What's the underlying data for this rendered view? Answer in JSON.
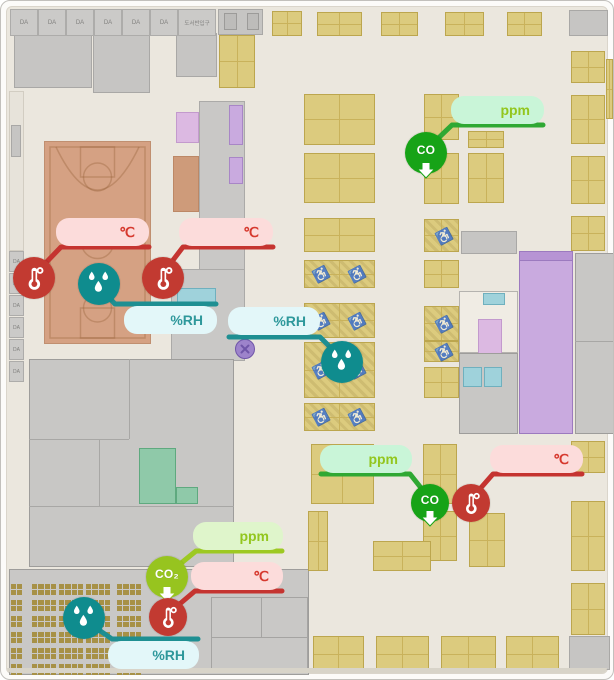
{
  "meta": {
    "title": "Library floor plan with environment sensors"
  },
  "strips": {
    "top_cells": {
      "labels": [
        "DA",
        "DA",
        "DA",
        "DA",
        "DA",
        "DA",
        "도서반입구"
      ],
      "x0": 9,
      "y": 8,
      "h": 27,
      "w": 28,
      "last_w": 38
    },
    "left_cells": {
      "labels": [
        "DA",
        "DP",
        "DA",
        "DA",
        "DA",
        "DA"
      ],
      "x": 8,
      "w": 15,
      "h": 21,
      "ys": [
        250,
        272,
        294,
        316,
        338,
        360
      ]
    }
  },
  "regions": [
    {
      "n": "left-corridor",
      "x": 8,
      "y": 90,
      "w": 15,
      "h": 160,
      "f": "#E7E3DA",
      "s": "#D2CDC2",
      "p": "p-vlinesg"
    },
    {
      "n": "left-gray-box",
      "x": 10,
      "y": 124,
      "w": 10,
      "h": 32,
      "f": "#C6C5C3",
      "s": "#A9A8A6"
    },
    {
      "n": "room-tl-1",
      "x": 13,
      "y": 32,
      "w": 78,
      "h": 55,
      "f": "#C6C5C3",
      "s": "#A9A8A6"
    },
    {
      "n": "room-tl-2",
      "x": 92,
      "y": 32,
      "w": 57,
      "h": 60,
      "f": "#C6C5C3",
      "s": "#A9A8A6"
    },
    {
      "n": "room-tl-3",
      "x": 175,
      "y": 32,
      "w": 41,
      "h": 44,
      "f": "#C6C5C3",
      "s": "#A9A8A6"
    },
    {
      "n": "equip-room-top",
      "x": 217,
      "y": 8,
      "w": 45,
      "h": 26,
      "f": "#C6C5C3",
      "s": "#A9A8A6"
    },
    {
      "n": "equip-box-a",
      "x": 223,
      "y": 12,
      "w": 13,
      "h": 17,
      "f": "#BDBCBA",
      "s": "#9C9B99"
    },
    {
      "n": "equip-box-b",
      "x": 246,
      "y": 12,
      "w": 12,
      "h": 17,
      "f": "#BDBCBA",
      "s": "#9C9B99"
    },
    {
      "n": "gray-top-right",
      "x": 568,
      "y": 9,
      "w": 39,
      "h": 26,
      "f": "#C6C5C3",
      "s": "#A9A8A6"
    },
    {
      "n": "corridor-mid",
      "x": 198,
      "y": 100,
      "w": 46,
      "h": 170,
      "f": "#C9C8C6",
      "s": "#ABAAA8"
    },
    {
      "n": "corridor-mid-low",
      "x": 170,
      "y": 268,
      "w": 74,
      "h": 92,
      "f": "#C9C8C6",
      "s": "#ABAAA8"
    },
    {
      "n": "stairs-pink",
      "x": 175,
      "y": 111,
      "w": 23,
      "h": 31,
      "f": "#DCB9E2",
      "s": "#C39ACD",
      "p": "p-stairs"
    },
    {
      "n": "bleacher-strip",
      "x": 172,
      "y": 155,
      "w": 26,
      "h": 56,
      "f": "#CE9B7A",
      "s": "#BC8866",
      "p": "p-hatchw"
    },
    {
      "n": "escalator-1",
      "x": 228,
      "y": 104,
      "w": 14,
      "h": 40,
      "f": "#C9AADF",
      "s": "#A886C6",
      "p": "p-stairs"
    },
    {
      "n": "escalator-2",
      "x": 228,
      "y": 156,
      "w": 14,
      "h": 27,
      "f": "#C9AADF",
      "s": "#A886C6",
      "p": "p-stairs"
    },
    {
      "n": "cyan-room-strip",
      "x": 176,
      "y": 287,
      "w": 39,
      "h": 15,
      "f": "#9FD2DB",
      "s": "#6FB0BE"
    },
    {
      "n": "court",
      "x": 43,
      "y": 140,
      "w": 107,
      "h": 203,
      "f": "#D5A183",
      "s": "#C08F70"
    },
    {
      "n": "block-left-big",
      "x": 28,
      "y": 358,
      "w": 205,
      "h": 208,
      "f": "#C8C7C5",
      "s": "#9E9D9B"
    },
    {
      "n": "block-line-1",
      "x": 28,
      "y": 438,
      "w": 100,
      "h": 1,
      "f": "#A8A7A5"
    },
    {
      "n": "block-line-2",
      "x": 128,
      "y": 358,
      "w": 1,
      "h": 80,
      "f": "#A8A7A5"
    },
    {
      "n": "block-line-3",
      "x": 28,
      "y": 505,
      "w": 205,
      "h": 1,
      "f": "#A8A7A5"
    },
    {
      "n": "block-line-4",
      "x": 98,
      "y": 438,
      "w": 1,
      "h": 67,
      "f": "#A8A7A5"
    },
    {
      "n": "meeting-room-teal",
      "x": 138,
      "y": 447,
      "w": 37,
      "h": 56,
      "f": "#8FC9A9",
      "s": "#5FA97F"
    },
    {
      "n": "meeting-room-teal-ext",
      "x": 175,
      "y": 486,
      "w": 22,
      "h": 17,
      "f": "#8FC9A9",
      "s": "#5FA97F"
    },
    {
      "n": "bottom-slab",
      "x": 8,
      "y": 568,
      "w": 300,
      "h": 106,
      "f": "#C9C8C6",
      "s": "#9E9D9B"
    },
    {
      "n": "slab-rooms-hatch",
      "x": 210,
      "y": 596,
      "w": 97,
      "h": 76,
      "f": "rgba(0,0,0,0)",
      "s": "#A5A4A2",
      "p": "p-hatchw"
    },
    {
      "n": "slab-room-line-v",
      "x": 260,
      "y": 596,
      "w": 1,
      "h": 40,
      "f": "#A5A4A2"
    },
    {
      "n": "slab-room-line-h",
      "x": 210,
      "y": 636,
      "w": 97,
      "h": 1,
      "f": "#A5A4A2"
    },
    {
      "n": "equip-room-center",
      "x": 460,
      "y": 230,
      "w": 56,
      "h": 23,
      "f": "#C6C5C3",
      "s": "#A9A8A6"
    },
    {
      "n": "lecture-hall-purple",
      "x": 518,
      "y": 250,
      "w": 54,
      "h": 183,
      "f": "#C9AADF",
      "s": "#9C7ABF",
      "p": "p-vlines"
    },
    {
      "n": "lecture-hall-header",
      "x": 518,
      "y": 250,
      "w": 54,
      "h": 10,
      "f": "#B794D4",
      "s": "#9C7ABF"
    },
    {
      "n": "gray-col-right",
      "x": 574,
      "y": 252,
      "w": 40,
      "h": 181,
      "f": "#C8C7C5",
      "s": "#9E9D9B"
    },
    {
      "n": "gray-col-line",
      "x": 574,
      "y": 340,
      "w": 40,
      "h": 1,
      "f": "#A8A7A5"
    },
    {
      "n": "rooms-center-white",
      "x": 458,
      "y": 290,
      "w": 59,
      "h": 62,
      "f": "#F0ECE4",
      "s": "#B5B3AF"
    },
    {
      "n": "cyan-small",
      "x": 482,
      "y": 292,
      "w": 22,
      "h": 12,
      "f": "#9FD2DB",
      "s": "#6FB0BE"
    },
    {
      "n": "stairs-pink-2",
      "x": 477,
      "y": 318,
      "w": 24,
      "h": 36,
      "f": "#DCB9E2",
      "s": "#C39ACD",
      "p": "p-stairs"
    },
    {
      "n": "gray-block-center",
      "x": 458,
      "y": 352,
      "w": 59,
      "h": 81,
      "f": "#C8C7C5",
      "s": "#9E9D9B"
    },
    {
      "n": "cyan-pair-a",
      "x": 462,
      "y": 366,
      "w": 19,
      "h": 20,
      "f": "#9FD2DB",
      "s": "#6FB0BE"
    },
    {
      "n": "cyan-pair-b",
      "x": 483,
      "y": 366,
      "w": 18,
      "h": 20,
      "f": "#9FD2DB",
      "s": "#6FB0BE"
    },
    {
      "n": "gray-corner-br",
      "x": 568,
      "y": 635,
      "w": 41,
      "h": 34,
      "f": "#C6C5C3",
      "s": "#A9A8A6"
    }
  ],
  "desks": [
    {
      "x": 271,
      "y": 10,
      "w": 30,
      "h": 25
    },
    {
      "x": 316,
      "y": 11,
      "w": 45,
      "h": 24
    },
    {
      "x": 380,
      "y": 11,
      "w": 37,
      "h": 24
    },
    {
      "x": 444,
      "y": 11,
      "w": 39,
      "h": 24
    },
    {
      "x": 506,
      "y": 11,
      "w": 35,
      "h": 24
    },
    {
      "x": 218,
      "y": 34,
      "w": 36,
      "h": 53
    },
    {
      "x": 570,
      "y": 50,
      "w": 34,
      "h": 32
    },
    {
      "x": 570,
      "y": 94,
      "w": 34,
      "h": 49
    },
    {
      "x": 570,
      "y": 155,
      "w": 34,
      "h": 48
    },
    {
      "x": 570,
      "y": 215,
      "w": 34,
      "h": 35
    },
    {
      "x": 605,
      "y": 58,
      "w": 7,
      "h": 60
    },
    {
      "x": 303,
      "y": 93,
      "w": 71,
      "h": 51
    },
    {
      "x": 423,
      "y": 93,
      "w": 35,
      "h": 46
    },
    {
      "x": 303,
      "y": 152,
      "w": 71,
      "h": 50
    },
    {
      "x": 423,
      "y": 152,
      "w": 35,
      "h": 51
    },
    {
      "x": 467,
      "y": 130,
      "w": 36,
      "h": 17
    },
    {
      "x": 467,
      "y": 152,
      "w": 36,
      "h": 50
    },
    {
      "x": 303,
      "y": 217,
      "w": 71,
      "h": 34
    },
    {
      "x": 423,
      "y": 218,
      "w": 35,
      "h": 33,
      "wc": true
    },
    {
      "x": 303,
      "y": 259,
      "w": 71,
      "h": 28,
      "wc": true
    },
    {
      "x": 423,
      "y": 259,
      "w": 35,
      "h": 28
    },
    {
      "x": 303,
      "y": 302,
      "w": 71,
      "h": 35,
      "wc": true
    },
    {
      "x": 423,
      "y": 305,
      "w": 35,
      "h": 35,
      "wc": true
    },
    {
      "x": 303,
      "y": 341,
      "w": 71,
      "h": 56,
      "wc": true
    },
    {
      "x": 423,
      "y": 340,
      "w": 35,
      "h": 21,
      "wc": true
    },
    {
      "x": 423,
      "y": 366,
      "w": 35,
      "h": 31
    },
    {
      "x": 303,
      "y": 402,
      "w": 71,
      "h": 28,
      "wc": true
    },
    {
      "x": 310,
      "y": 443,
      "w": 63,
      "h": 60
    },
    {
      "x": 307,
      "y": 510,
      "w": 20,
      "h": 60
    },
    {
      "x": 422,
      "y": 443,
      "w": 34,
      "h": 60
    },
    {
      "x": 422,
      "y": 510,
      "w": 34,
      "h": 50
    },
    {
      "x": 468,
      "y": 512,
      "w": 36,
      "h": 54
    },
    {
      "x": 372,
      "y": 540,
      "w": 58,
      "h": 30
    },
    {
      "x": 570,
      "y": 440,
      "w": 34,
      "h": 32
    },
    {
      "x": 570,
      "y": 500,
      "w": 34,
      "h": 70
    },
    {
      "x": 570,
      "y": 582,
      "w": 34,
      "h": 52
    },
    {
      "x": 312,
      "y": 635,
      "w": 51,
      "h": 36
    },
    {
      "x": 375,
      "y": 635,
      "w": 53,
      "h": 36
    },
    {
      "x": 440,
      "y": 635,
      "w": 55,
      "h": 36
    },
    {
      "x": 505,
      "y": 635,
      "w": 53,
      "h": 36
    }
  ],
  "classroom": {
    "cols": [
      {
        "x": 10,
        "w": 11,
        "cells": 2
      },
      {
        "x": 31,
        "w": 24,
        "cells": 4
      },
      {
        "x": 58,
        "w": 24,
        "cells": 4
      },
      {
        "x": 85,
        "w": 24,
        "cells": 4
      },
      {
        "x": 116,
        "w": 24,
        "cells": 4
      }
    ],
    "rows": [
      583,
      599,
      615,
      631,
      647,
      663
    ],
    "h": 11
  },
  "marker_x": {
    "x": 243,
    "y": 347,
    "r": 9,
    "fill": "#9D83CB",
    "stroke": "#6F55A8"
  },
  "sensors": [
    {
      "id": "temp-court-left",
      "kind": "temp",
      "icon": "thermometer-icon",
      "bubble_label": "℃",
      "bubble": [
        55,
        217,
        93,
        28
      ],
      "circle": [
        33,
        277,
        21
      ],
      "path": "148,246 60,246 35,272"
    },
    {
      "id": "temp-court-right",
      "kind": "temp",
      "icon": "thermometer-icon",
      "bubble_label": "℃",
      "bubble": [
        178,
        217,
        94,
        28
      ],
      "circle": [
        162,
        277,
        21
      ],
      "path": "272,246 182,246 163,271"
    },
    {
      "id": "humidity-court",
      "kind": "hum",
      "icon": "humidity-drops-icon",
      "bubble_label": "%RH",
      "bubble": [
        123,
        305,
        93,
        28
      ],
      "circle": [
        98,
        283,
        21
      ],
      "path": "215,303 114,303 99,287"
    },
    {
      "id": "humidity-reading-room",
      "kind": "hum",
      "icon": "humidity-drops-icon",
      "bubble_label": "%RH",
      "bubble": [
        227,
        306,
        92,
        28
      ],
      "circle": [
        341,
        361,
        21
      ],
      "path": "228,336 319,336 340,357"
    },
    {
      "id": "co-reading-room-top",
      "kind": "co",
      "icon": "co-arrow-icon",
      "circle_label": "CO",
      "bubble_label": "ppm",
      "bubble": [
        450,
        95,
        93,
        28
      ],
      "circle": [
        425,
        152,
        21
      ],
      "path": "542,124 451,124 426,148"
    },
    {
      "id": "co-reading-room-bottom",
      "kind": "co",
      "icon": "co-arrow-icon",
      "circle_label": "CO",
      "bubble_label": "ppm",
      "bubble": [
        319,
        444,
        92,
        28
      ],
      "circle": [
        429,
        502,
        19
      ],
      "path": "320,473 409,473 428,497"
    },
    {
      "id": "temp-reading-room-bottom",
      "kind": "temp",
      "icon": "thermometer-icon",
      "bubble_label": "℃",
      "bubble": [
        489,
        444,
        93,
        28
      ],
      "circle": [
        470,
        502,
        19
      ],
      "path": "581,473 492,473 471,497"
    },
    {
      "id": "co2-hall",
      "kind": "co2",
      "icon": "co2-arrow-icon",
      "circle_label": "CO₂",
      "bubble_label": "ppm",
      "bubble": [
        192,
        521,
        90,
        28
      ],
      "circle": [
        166,
        576,
        21
      ],
      "path": "281,550 195,550 168,572"
    },
    {
      "id": "temp-hall",
      "kind": "temp",
      "icon": "thermometer-icon",
      "bubble_label": "℃",
      "bubble": [
        190,
        561,
        92,
        28
      ],
      "circle": [
        167,
        616,
        19
      ],
      "path": "281,590 194,590 168,612"
    },
    {
      "id": "humidity-hall",
      "kind": "hum",
      "icon": "humidity-drops-icon",
      "bubble_label": "%RH",
      "bubble": [
        107,
        640,
        91,
        28
      ],
      "circle": [
        83,
        617,
        21
      ],
      "path": "197,638 111,638 85,620"
    }
  ],
  "sensor_styles": {
    "temp": {
      "line": "#C53430",
      "circle": "#C23A31",
      "bubble": "#FCDCDB",
      "text": "#D6392E"
    },
    "hum": {
      "line": "#1E8F92",
      "circle": "#0F8C8E",
      "bubble": "#E3F7F9",
      "text": "#2E989B"
    },
    "co": {
      "line": "#2FA833",
      "circle": "#17A317",
      "bubble": "#C9F5D8",
      "text": "#93C61E"
    },
    "co2": {
      "line": "#9DC922",
      "circle": "#97C41F",
      "bubble": "#DFF5CB",
      "text": "#93C61E"
    }
  }
}
